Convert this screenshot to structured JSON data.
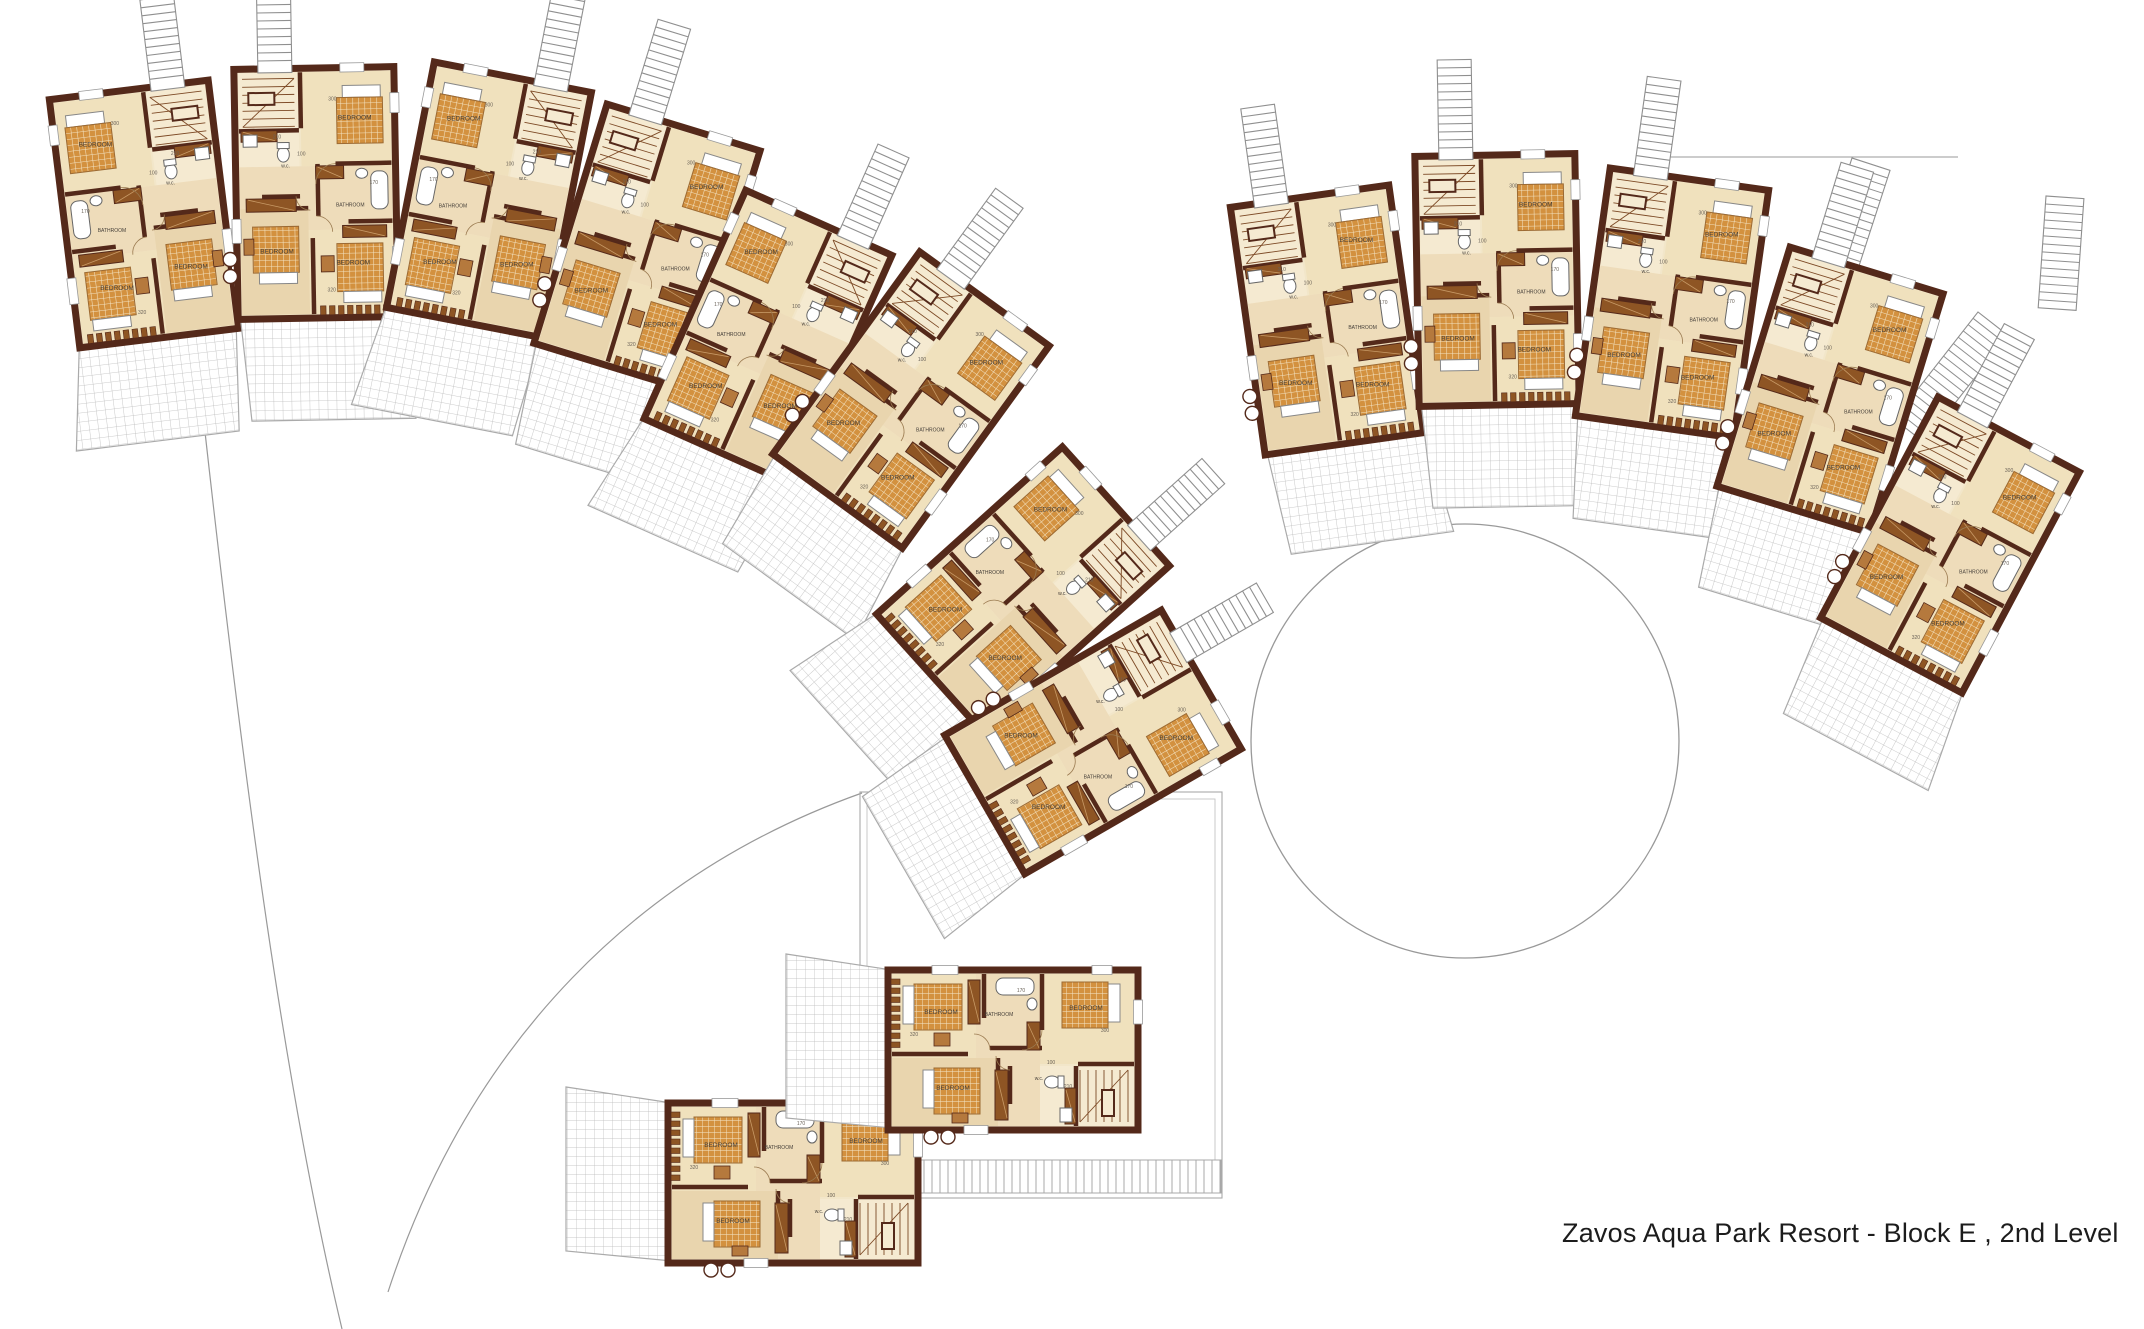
{
  "title": "Zavos Aqua Park Resort - Block E , 2nd Level",
  "labels": {
    "bedroom": "BEDROOM",
    "bathroom": "BATHROOM",
    "wc": "w.c."
  },
  "dims": {
    "d100": "100",
    "d110": "110",
    "d170": "170",
    "d210": "210",
    "d300": "300",
    "d320": "320"
  },
  "colors": {
    "wall_dark": "#54291a",
    "floor_cream": "#f2e6c9",
    "floor_tan": "#e9d5ae",
    "hall_tan": "#eedcba",
    "bed_orange": "#d3913f",
    "bed_grid": "#f3e3c2",
    "furniture_brown": "#8e5524",
    "furniture_light": "#b5793d",
    "stair_line": "#7d4a26",
    "site_gray": "#999999",
    "tile_gray": "#bcbcbc",
    "label_text": "#46403a",
    "dim_text": "#6a6258",
    "title_text": "#1c1c1c"
  },
  "units": [
    {
      "id": "L1",
      "cx": 144,
      "cy": 214,
      "rot": -7,
      "mirror": false,
      "ladder": true
    },
    {
      "id": "L2",
      "cx": 316,
      "cy": 193,
      "rot": -1,
      "mirror": true,
      "ladder": true
    },
    {
      "id": "L3",
      "cx": 489,
      "cy": 200,
      "rot": 11,
      "mirror": false,
      "ladder": true
    },
    {
      "id": "L4",
      "cx": 647,
      "cy": 247,
      "rot": 17,
      "mirror": true,
      "ladder": true
    },
    {
      "id": "L5",
      "cx": 768,
      "cy": 337,
      "rot": 24,
      "mirror": false,
      "ladder": true
    },
    {
      "id": "L6",
      "cx": 911,
      "cy": 400,
      "rot": 36,
      "mirror": true,
      "ladder": true
    },
    {
      "id": "L7",
      "cx": 1023,
      "cy": 590,
      "rot": 48,
      "mirror": false,
      "ladder": true
    },
    {
      "id": "L8",
      "cx": 1093,
      "cy": 742,
      "rot": 60,
      "mirror": true,
      "ladder": true
    },
    {
      "id": "R1",
      "cx": 1327,
      "cy": 320,
      "rot": -8,
      "mirror": true,
      "ladder": true
    },
    {
      "id": "R2",
      "cx": 1497,
      "cy": 280,
      "rot": -1,
      "mirror": true,
      "ladder": true
    },
    {
      "id": "R3",
      "cx": 1672,
      "cy": 303,
      "rot": 8,
      "mirror": true,
      "ladder": true
    },
    {
      "id": "R4",
      "cx": 1830,
      "cy": 390,
      "rot": 17,
      "mirror": true,
      "ladder": true
    },
    {
      "id": "R5",
      "cx": 1950,
      "cy": 545,
      "rot": 28,
      "mirror": true,
      "ladder": true
    },
    {
      "id": "B1",
      "cx": 793,
      "cy": 1183,
      "rot": 90,
      "mirror": false,
      "ladder": false
    },
    {
      "id": "B2",
      "cx": 1013,
      "cy": 1050,
      "rot": 90,
      "mirror": false,
      "ladder": false
    }
  ],
  "site": {
    "circle": {
      "cx": 1465,
      "cy": 741,
      "rx": 214,
      "ry": 217
    },
    "paths": [
      "M205,432 C245,790 285,1090 342,1329",
      "M388,1292 C470,1040 640,872 862,793"
    ],
    "deck": {
      "x": 860,
      "y": 792,
      "w": 362,
      "h": 406
    },
    "railings": [
      {
        "x": 1388,
        "y": 458,
        "w": 202,
        "h": 40,
        "rot": 0
      },
      {
        "x": 903,
        "y": 1160,
        "w": 318,
        "h": 33,
        "rot": 0
      }
    ],
    "ladders": [
      {
        "x": 1852,
        "y": 158,
        "w": 40,
        "h": 118,
        "rot": 18
      },
      {
        "x": 2046,
        "y": 196,
        "w": 38,
        "h": 112,
        "rot": 4
      },
      {
        "x": 1978,
        "y": 312,
        "w": 38,
        "h": 136,
        "rot": 38
      }
    ],
    "topline": {
      "x1": 1660,
      "y1": 157,
      "x2": 1958,
      "y2": 157
    }
  }
}
